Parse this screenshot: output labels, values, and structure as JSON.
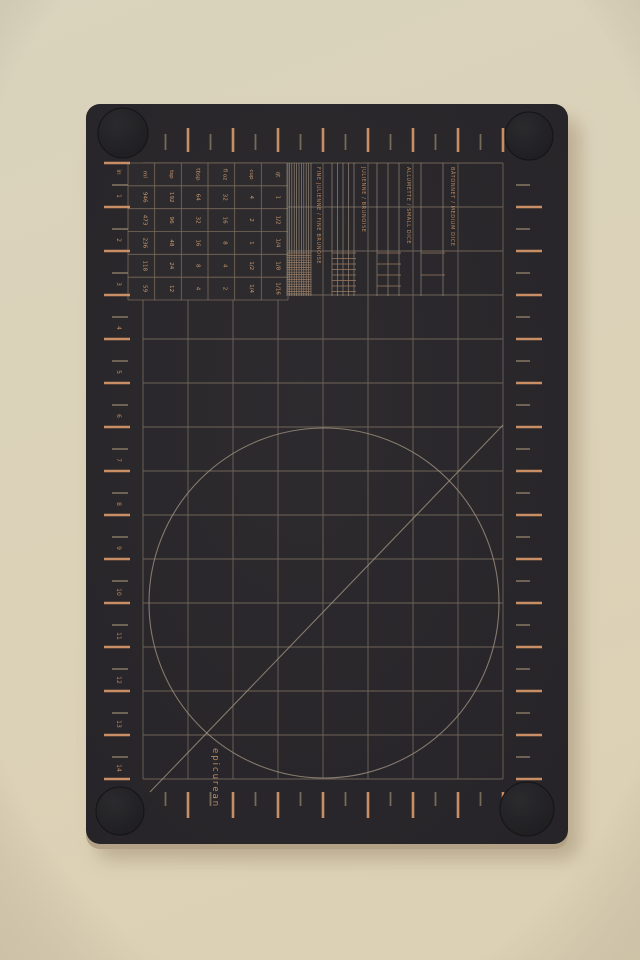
{
  "photo": {
    "subject": "dark prep cutting board with copper measurement markings on beige surface"
  },
  "board": {
    "brand": "epicurean",
    "ruler": {
      "unit_label": "in",
      "numbers": [
        "1",
        "2",
        "3",
        "4",
        "5",
        "6",
        "7",
        "8",
        "9",
        "10",
        "11",
        "12",
        "13",
        "14"
      ]
    },
    "conversion_table": {
      "columns": [
        "ml",
        "tsp",
        "tbsp",
        "fl oz",
        "cup",
        "qt"
      ],
      "rows": [
        [
          "946",
          "192",
          "64",
          "32",
          "4",
          "1"
        ],
        [
          "473",
          "96",
          "32",
          "16",
          "2",
          "1/2"
        ],
        [
          "236",
          "48",
          "16",
          "8",
          "1",
          "1/4"
        ],
        [
          "118",
          "24",
          "8",
          "4",
          "1/2",
          "1/8"
        ],
        [
          "59",
          "12",
          "4",
          "2",
          "1/4",
          "1/16"
        ]
      ]
    },
    "cut_guides": [
      {
        "label": "FINE JULIENNE / FINE BRUNOISE",
        "spacing": 2.4
      },
      {
        "label": "JULIENNE / BRUNOISE",
        "spacing": 5.5
      },
      {
        "label": "ALLUMETTE / SMALL DICE",
        "spacing": 11
      },
      {
        "label": "BÂTONNET / MEDIUM DICE",
        "spacing": 22
      }
    ]
  },
  "colors": {
    "background_top": "#dad3bd",
    "background_bottom": "#ddd1b5",
    "board_dark": "#2d2b2e",
    "board_darker": "#252327",
    "board_edge": "#b3a285",
    "foot_dark": "#1b1a1d",
    "copper_bright": "#d29468",
    "copper_mid": "#bd8a60",
    "copper_text": "#c89a72",
    "grid_line": "#7e7567",
    "half_tick": "#97876f",
    "guide_line": "#a49684",
    "shadow": "#b4a488"
  }
}
